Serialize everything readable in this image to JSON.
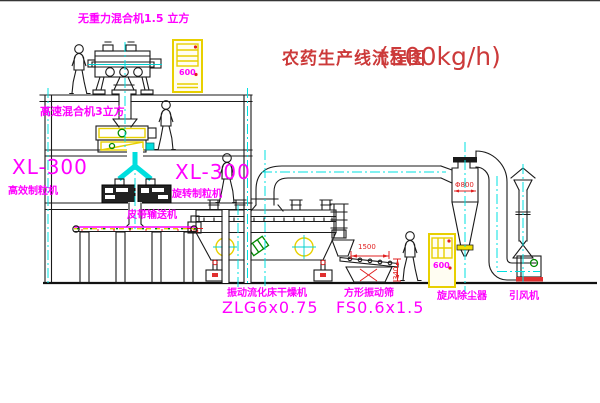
{
  "title": {
    "name": "农药生产线流程图",
    "capacity": "(500kg/h)"
  },
  "equipment_labels": {
    "gravity_mixer": "无重力混合机1.5 立方",
    "high_speed_mixer": "高速混合机3立方",
    "granulator_left": {
      "model": "XL-300",
      "name": "高效制粒机"
    },
    "granulator_mid": {
      "model": "XL-300",
      "name": "旋转制粒机"
    },
    "belt_conveyor": "皮带输送机",
    "fluid_bed_dryer": {
      "name": "振动流化床干燥机",
      "model": "ZLG6x0.75"
    },
    "vibrating_screen": {
      "name": "方形振动筛",
      "model": "FS0.6x1.5"
    },
    "cyclone": "旋风除尘器",
    "induced_draft_fan": "引风机"
  },
  "dimension_annotations": {
    "cyclone_diameter": "Φ800",
    "screen_length": "1500",
    "screen_height": "340"
  },
  "control_cabinets": [
    {
      "label": "600"
    },
    {
      "label": "600"
    }
  ],
  "colors": {
    "label_magenta": "#ff00ff",
    "title_red": "#cc3a3a",
    "dimension_red": "#e02020",
    "centerline_cyan": "#00e0e0",
    "cabinet_yellow": "#e8d000",
    "line_black": "#1a1a1a",
    "motor_green": "#008800"
  }
}
